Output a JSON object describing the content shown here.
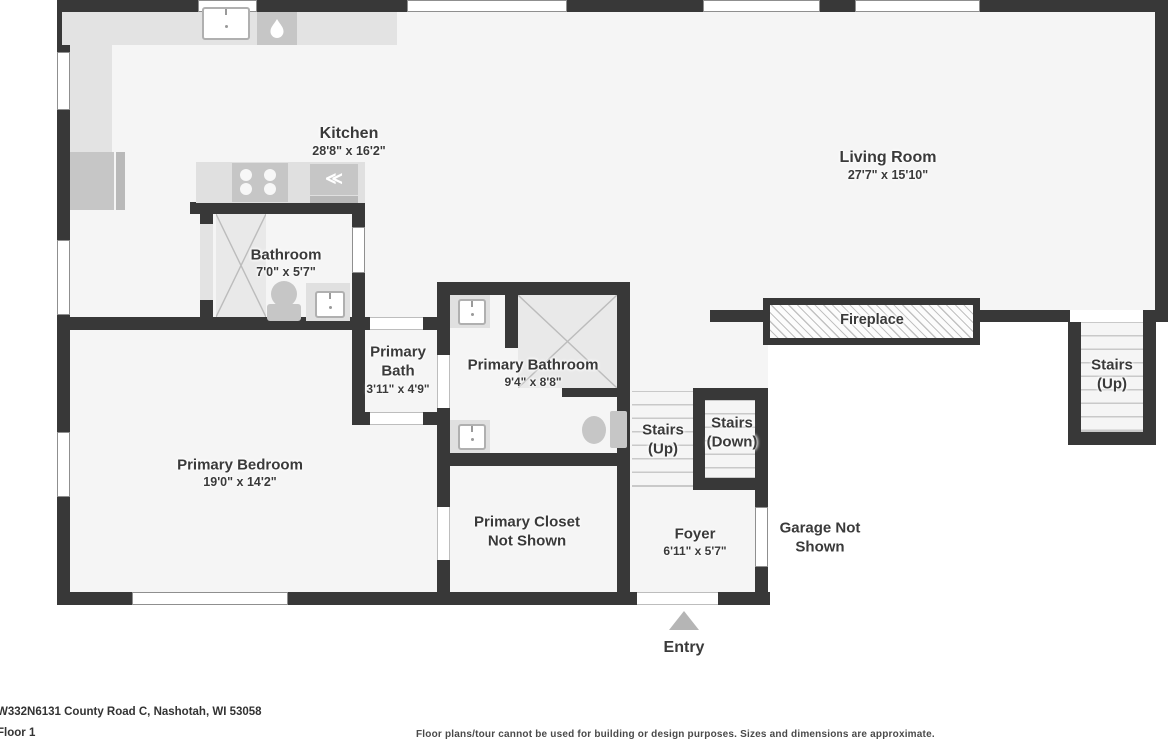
{
  "page": {
    "address": "W332N6131 County Road C, Nashotah, WI 53058",
    "floor": "Floor 1",
    "disclaimer": "Floor plans/tour cannot be used for building or design purposes. Sizes and dimensions are approximate."
  },
  "rooms": {
    "kitchen": {
      "name": "Kitchen",
      "dims": "28'8\" x 16'2\""
    },
    "living_room": {
      "name": "Living Room",
      "dims": "27'7\" x 15'10\""
    },
    "bathroom": {
      "name": "Bathroom",
      "dims": "7'0\" x 5'7\""
    },
    "primary_bath": {
      "line1": "Primary",
      "line2": "Bath",
      "dims": "3'11\" x 4'9\""
    },
    "primary_bathroom": {
      "name": "Primary Bathroom",
      "dims": "9'4\" x 8'8\""
    },
    "primary_bedroom": {
      "name": "Primary Bedroom",
      "dims": "19'0\" x 14'2\""
    },
    "primary_closet": {
      "line1": "Primary Closet",
      "line2": "Not Shown"
    },
    "foyer": {
      "name": "Foyer",
      "dims": "6'11\" x 5'7\""
    },
    "garage": {
      "line1": "Garage Not",
      "line2": "Shown"
    },
    "stairs_mid_up": {
      "line1": "Stairs",
      "line2": "(Up)"
    },
    "stairs_mid_down": {
      "line1": "Stairs",
      "line2": "(Down)"
    },
    "stairs_right_up": {
      "line1": "Stairs",
      "line2": "(Up)"
    },
    "fireplace": {
      "name": "Fireplace"
    },
    "entry": {
      "name": "Entry"
    }
  },
  "colors": {
    "wall": "#383838",
    "floor": "#f5f5f5",
    "counter": "#e3e3e3",
    "text": "#3a3a3a"
  }
}
